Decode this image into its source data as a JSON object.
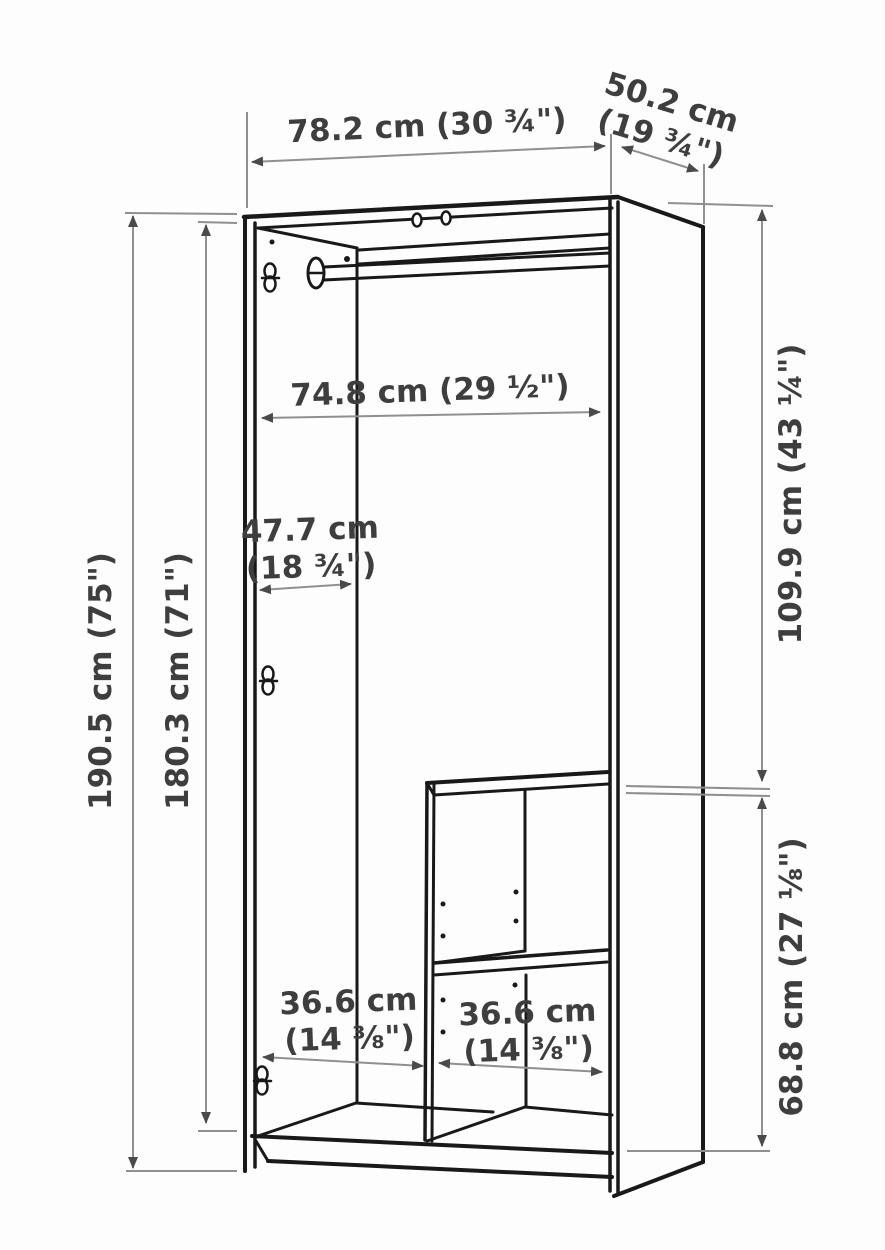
{
  "diagram": {
    "title": "Wardrobe dimension diagram",
    "colors": {
      "line_art": "#191919",
      "dimension_line": "#8f8f8f",
      "arrowhead": "#4a4a4a",
      "label_text": "#3e3e3e",
      "background": "#fdfdfd"
    },
    "dimensions": {
      "overall_width": "78.2 cm (30 ¾\")",
      "depth_line1": "50.2 cm",
      "depth_line2": "(19 ¾\")",
      "overall_height": "190.5 cm (75\")",
      "interior_height": "180.3 cm (71\")",
      "interior_width": "74.8 cm (29 ½\")",
      "interior_depth_line1": "47.7 cm",
      "interior_depth_line2": "(18 ¾\")",
      "upper_section_height": "109.9 cm (43 ¼\")",
      "lower_section_height": "68.8 cm (27 ⅛\")",
      "left_compartment_width_line1": "36.6 cm",
      "left_compartment_width_line2": "(14 ⅜\")",
      "right_compartment_width_line1": "36.6 cm",
      "right_compartment_width_line2": "(14 ⅜\")"
    }
  }
}
